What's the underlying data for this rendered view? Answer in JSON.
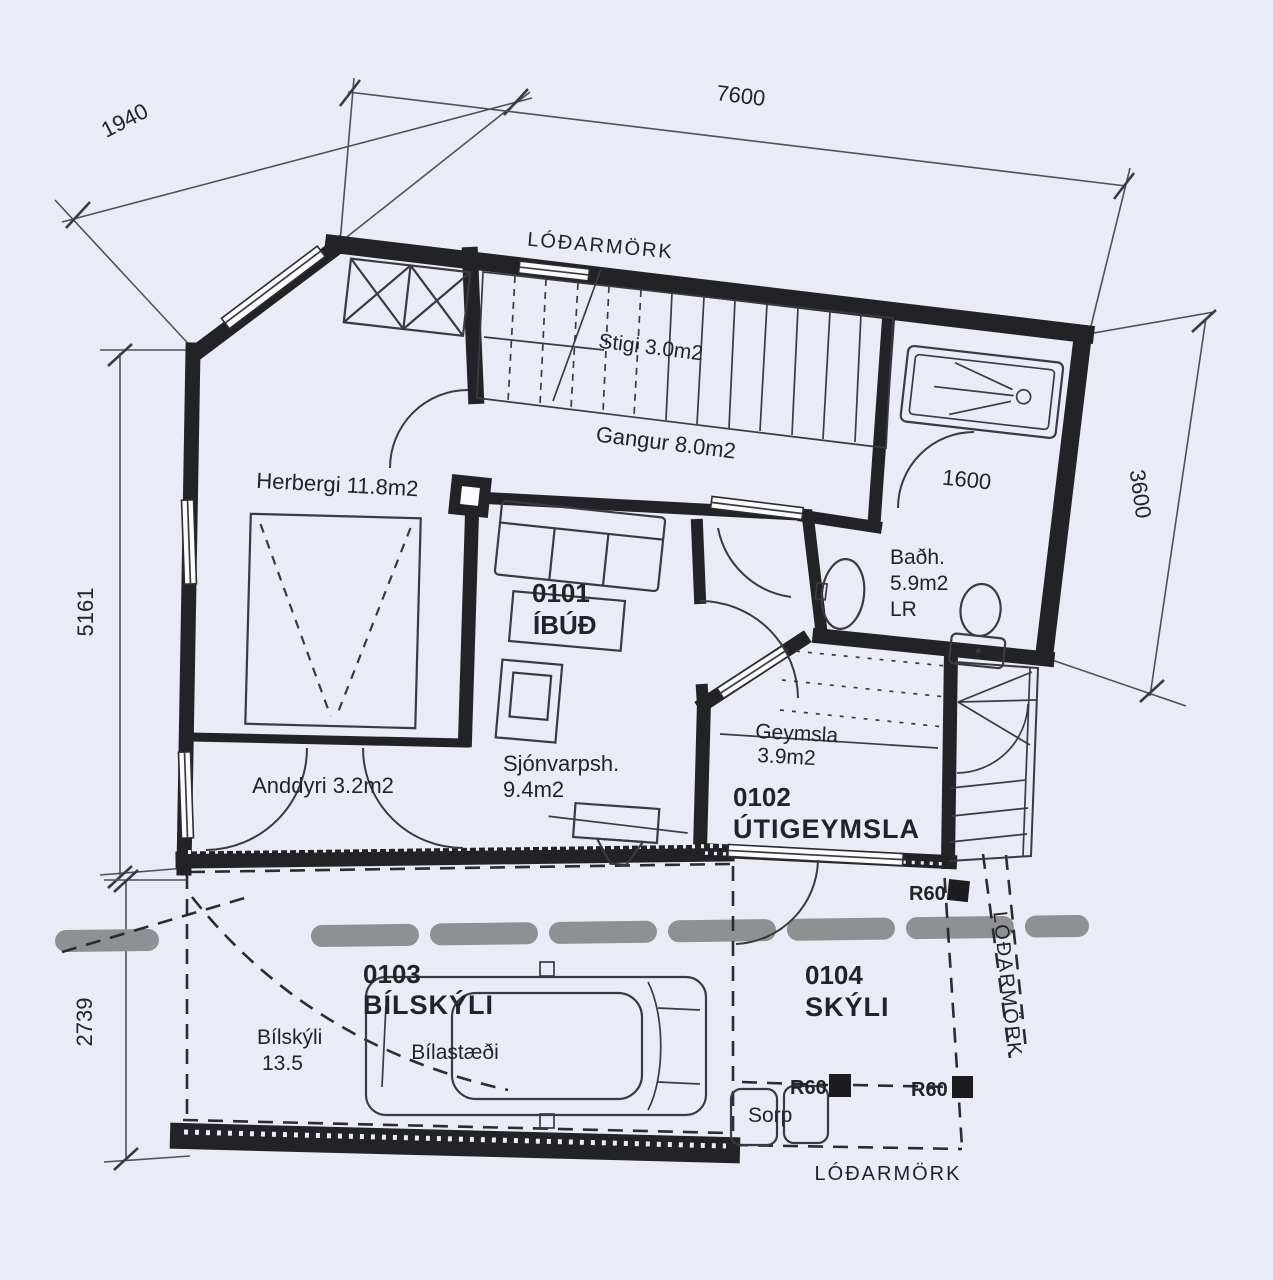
{
  "colors": {
    "background": "#e9ebf6",
    "wall_ink": "#232327",
    "thin_line": "#3a3a40",
    "road_gray": "#8f9094"
  },
  "boundary": {
    "label_top": "LÓÐARMÖRK",
    "label_right": "LÓÐARMÖRK",
    "label_bottom": "LÓÐARMÖRK",
    "fire_marker": "R60"
  },
  "dimensions": {
    "chamfer": "1940",
    "top_width": "7600",
    "left_height": "5161",
    "carport_height": "2739",
    "right_height": "3600",
    "bath_door_width": "1600"
  },
  "rooms": {
    "stairs": {
      "label": "Stigi 3.0m2"
    },
    "hallway": {
      "label": "Gangur 8.0m2"
    },
    "bedroom": {
      "label": "Herbergi 11.8m2"
    },
    "apartment": {
      "number": "0101",
      "name": "ÍBÚÐ"
    },
    "bathroom": {
      "line1": "Baðh.",
      "line2": "5.9m2",
      "line3": "LR"
    },
    "storage": {
      "line1": "Geymsla",
      "line2": "3.9m2"
    },
    "outdoor_storage": {
      "number": "0102",
      "name": "ÚTIGEYMSLA"
    },
    "tv_room": {
      "line1": "Sjónvarpsh.",
      "line2": "9.4m2"
    },
    "entrance": {
      "label": "Anddyri 3.2m2"
    },
    "carport": {
      "number": "0103",
      "name": "BÍLSKÝLI",
      "area_line1": "Bílskýli",
      "area_line2": "13.5",
      "parking": "Bílastæði"
    },
    "shelter": {
      "number": "0104",
      "name": "SKÝLI"
    },
    "waste": {
      "label": "Sorp"
    }
  }
}
